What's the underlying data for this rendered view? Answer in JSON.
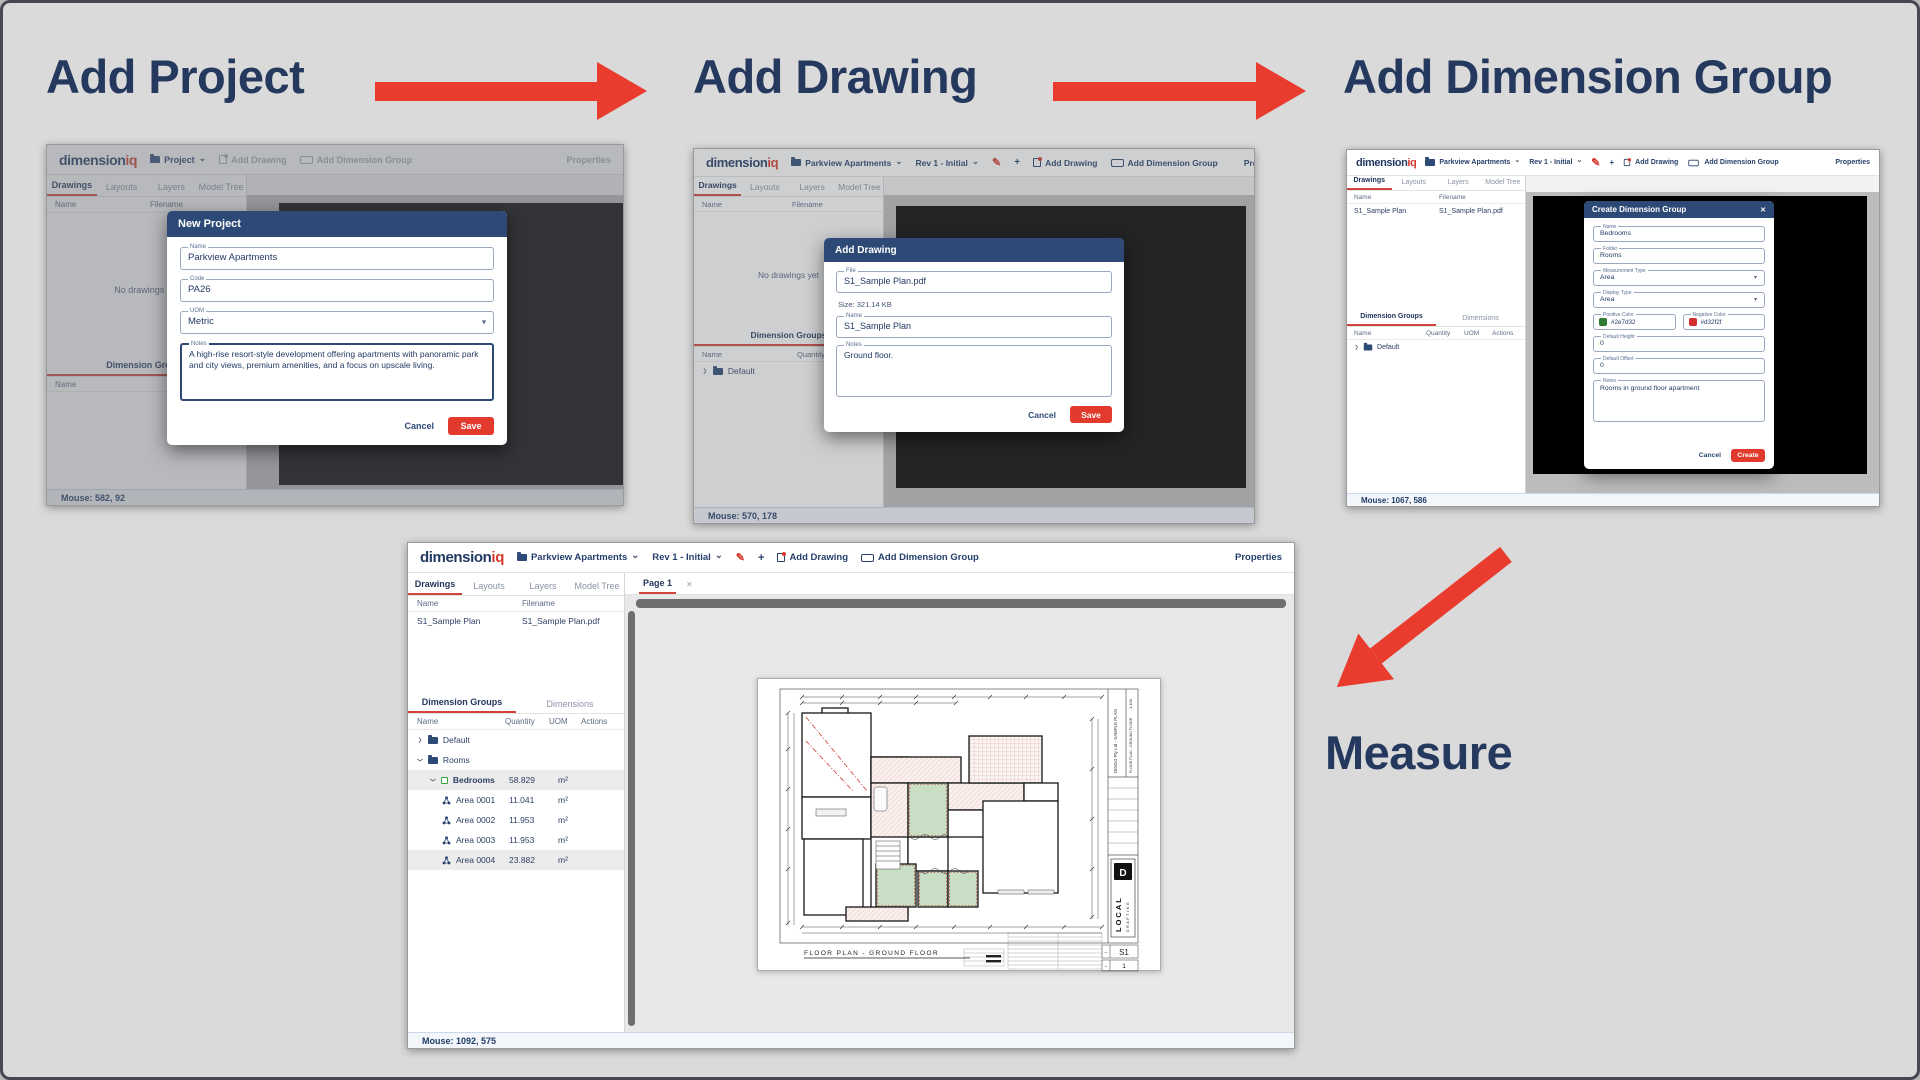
{
  "headings": {
    "step1": "Add Project",
    "step2": "Add Drawing",
    "step3": "Add Dimension Group",
    "step4": "Measure"
  },
  "colors": {
    "accent_red": "#e93c2e",
    "heading_navy": "#25395e",
    "modal_header_navy": "#2d4a77",
    "positive_green": "#2e7d32",
    "negative_red": "#d32f2f"
  },
  "brand": {
    "main": "dimension",
    "accent": "iq"
  },
  "shot1": {
    "nav": {
      "project": "Project",
      "add_drawing": "Add Drawing",
      "add_group": "Add Dimension Group",
      "properties": "Properties"
    },
    "tabs": [
      "Drawings",
      "Layouts",
      "Layers",
      "Model Tree"
    ],
    "drawings": {
      "col1": "Name",
      "col2": "Filename",
      "empty": "No drawings yet"
    },
    "groups": {
      "tab1": "Dimension Groups",
      "col1": "Name"
    },
    "modal": {
      "title": "New Project",
      "name_label": "Name",
      "name_value": "Parkview Apartments",
      "code_label": "Code",
      "code_value": "PA26",
      "uom_label": "UOM",
      "uom_value": "Metric",
      "notes_label": "Notes",
      "notes_value": "A high-rise resort-style development offering apartments with panoramic park and city views, premium amenities, and a focus on upscale living.",
      "cancel": "Cancel",
      "save": "Save"
    },
    "status": "Mouse: 582, 92"
  },
  "shot2": {
    "nav": {
      "project": "Parkview Apartments",
      "rev": "Rev 1 - Initial",
      "add_drawing": "Add Drawing",
      "add_group": "Add Dimension Group",
      "properties": "Properties"
    },
    "tabs": [
      "Drawings",
      "Layouts",
      "Layers",
      "Model Tree"
    ],
    "drawings": {
      "col1": "Name",
      "col2": "Filename",
      "empty": "No drawings yet"
    },
    "groups": {
      "tab1": "Dimension Groups",
      "col1": "Name",
      "col2": "Quantity",
      "row_default": "Default"
    },
    "modal": {
      "title": "Add Drawing",
      "file_label": "File",
      "file_value": "S1_Sample Plan.pdf",
      "size_text": "Size: 321.14 KB",
      "name_label": "Name",
      "name_value": "S1_Sample Plan",
      "notes_label": "Notes",
      "notes_value": "Ground floor.",
      "cancel": "Cancel",
      "save": "Save"
    },
    "status": "Mouse: 570, 178"
  },
  "shot3": {
    "nav": {
      "project": "Parkview Apartments",
      "rev": "Rev 1 - Initial",
      "add_drawing": "Add Drawing",
      "add_group": "Add Dimension Group",
      "properties": "Properties"
    },
    "tabs": [
      "Drawings",
      "Layouts",
      "Layers",
      "Model Tree"
    ],
    "drawings": {
      "col1": "Name",
      "col2": "Filename",
      "row_name": "S1_Sample Plan",
      "row_file": "S1_Sample Plan.pdf"
    },
    "groups": {
      "tab1": "Dimension Groups",
      "tab2": "Dimensions",
      "col1": "Name",
      "col2": "Quantity",
      "col3": "UOM",
      "col4": "Actions",
      "row_default": "Default"
    },
    "modal": {
      "title": "Create Dimension Group",
      "name_label": "Name",
      "name_value": "Bedrooms",
      "folder_label": "Folder",
      "folder_value": "Rooms",
      "mtype_label": "Measurement Type",
      "mtype_value": "Area",
      "dtype_label": "Display Type",
      "dtype_value": "Area",
      "pos_label": "Positive Color",
      "pos_value": "#2e7d32",
      "neg_label": "Negative Color",
      "neg_value": "#d32f2f",
      "height_label": "Default Height",
      "height_value": "0",
      "offset_label": "Default Offset",
      "offset_value": "0",
      "notes_label": "Notes",
      "notes_value": "Rooms in ground floor apartment",
      "cancel": "Cancel",
      "create": "Create"
    },
    "status": "Mouse: 1067, 586"
  },
  "shot4": {
    "nav": {
      "project": "Parkview Apartments",
      "rev": "Rev 1 - Initial",
      "add_drawing": "Add Drawing",
      "add_group": "Add Dimension Group",
      "properties": "Properties"
    },
    "tabs": [
      "Drawings",
      "Layouts",
      "Layers",
      "Model Tree"
    ],
    "page_tab": "Page 1",
    "drawings": {
      "col1": "Name",
      "col2": "Filename",
      "row_name": "S1_Sample Plan",
      "row_file": "S1_Sample Plan.pdf"
    },
    "groups": {
      "tab1": "Dimension Groups",
      "tab2": "Dimensions",
      "col1": "Name",
      "col2": "Quantity",
      "col3": "UOM",
      "col4": "Actions",
      "tree": [
        {
          "name": "Default",
          "qty": "",
          "uom": ""
        },
        {
          "name": "Rooms",
          "qty": "",
          "uom": ""
        },
        {
          "name": "Bedrooms",
          "qty": "58.829",
          "uom": "m²"
        },
        {
          "name": "Area 0001",
          "qty": "11.041",
          "uom": "m²"
        },
        {
          "name": "Area 0002",
          "qty": "11.953",
          "uom": "m²"
        },
        {
          "name": "Area 0003",
          "qty": "11.953",
          "uom": "m²"
        },
        {
          "name": "Area 0004",
          "qty": "23.882",
          "uom": "m²"
        }
      ]
    },
    "plan": {
      "title": "FLOOR PLAN - GROUND FLOOR",
      "project": "DINGO Pty Ltd - SAMPLE PLAN",
      "scale": "1:100",
      "logo_d": "D",
      "logo1": "LOCAL",
      "logo2": "DRAFTING",
      "sheet_no": "S1",
      "rev_no": "1"
    },
    "status": "Mouse: 1092, 575"
  }
}
